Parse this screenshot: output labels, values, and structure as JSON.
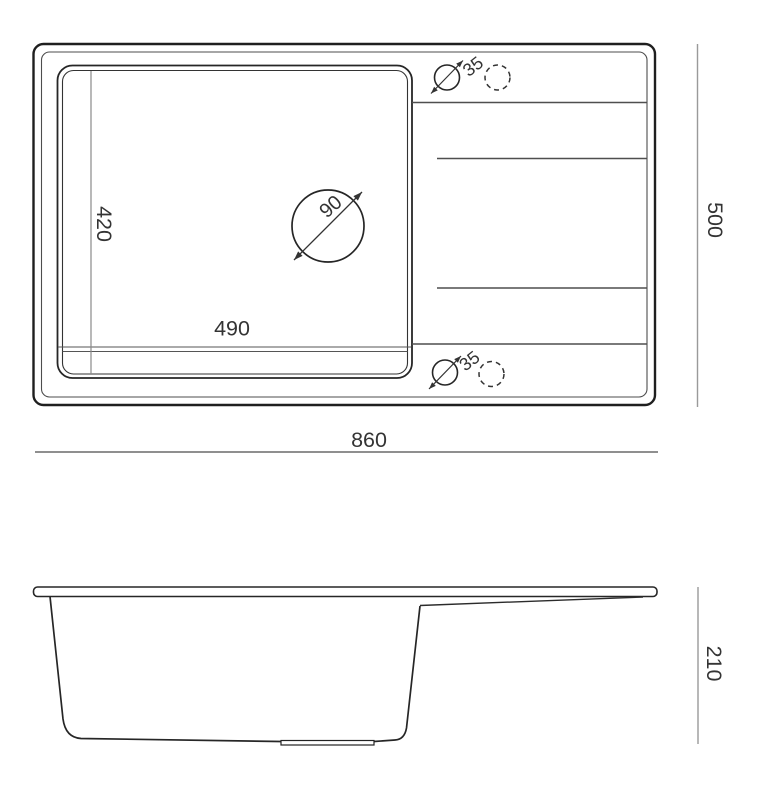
{
  "drawing": {
    "top_view": {
      "overall_width_label": "860",
      "overall_depth_label": "500",
      "bowl_width_label": "490",
      "bowl_depth_label": "420",
      "drain_hole_diameter_label": "90",
      "tap_hole_top_diameter_label": "35",
      "tap_hole_bottom_diameter_label": "35"
    },
    "side_view": {
      "height_label": "210"
    },
    "colors": {
      "outline": "#1f1f1f",
      "secondary_line": "#4f4f4f",
      "dimension_line": "#8f8f8f",
      "text": "#343434",
      "background": "#ffffff"
    }
  }
}
